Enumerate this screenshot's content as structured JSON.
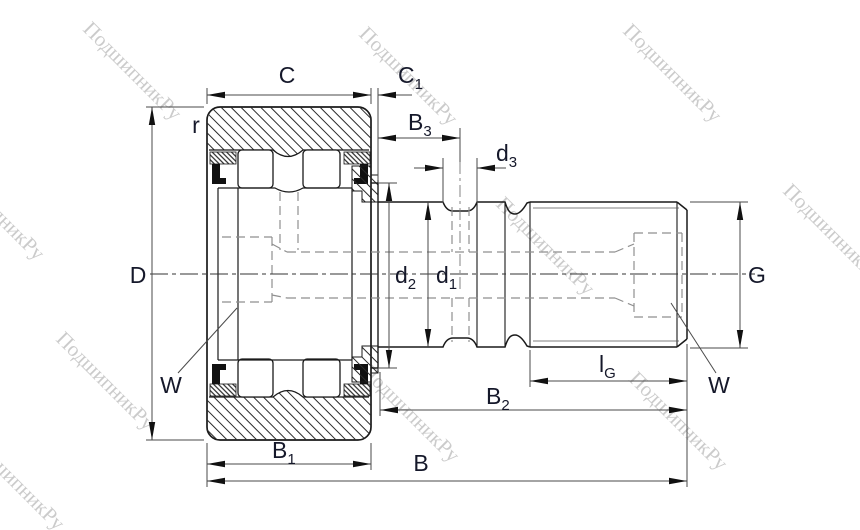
{
  "drawing": {
    "kind": "bearing-technical-drawing",
    "subject": "stud-type track roller cam follower cross-section"
  },
  "labels": {
    "C": {
      "main": "C",
      "sub": ""
    },
    "C1": {
      "main": "C",
      "sub": "1"
    },
    "B3": {
      "main": "B",
      "sub": "3"
    },
    "d3": {
      "main": "d",
      "sub": "3"
    },
    "r": {
      "main": "r",
      "sub": ""
    },
    "D": {
      "main": "D",
      "sub": ""
    },
    "d2": {
      "main": "d",
      "sub": "2"
    },
    "d1": {
      "main": "d",
      "sub": "1"
    },
    "G": {
      "main": "G",
      "sub": ""
    },
    "W_left": {
      "main": "W",
      "sub": ""
    },
    "W_right": {
      "main": "W",
      "sub": ""
    },
    "lG": {
      "main": "l",
      "sub": "G"
    },
    "B2": {
      "main": "B",
      "sub": "2"
    },
    "B1": {
      "main": "B",
      "sub": "1"
    },
    "B": {
      "main": "B",
      "sub": ""
    }
  },
  "watermark": {
    "text": "ПодшипникРу",
    "color": "#c3c3c3"
  },
  "colors": {
    "background": "#ffffff",
    "outline": "#1a1a1a",
    "dimension": "#3a3a3a",
    "hidden": "#8f8f8f",
    "label": "#15182a"
  }
}
